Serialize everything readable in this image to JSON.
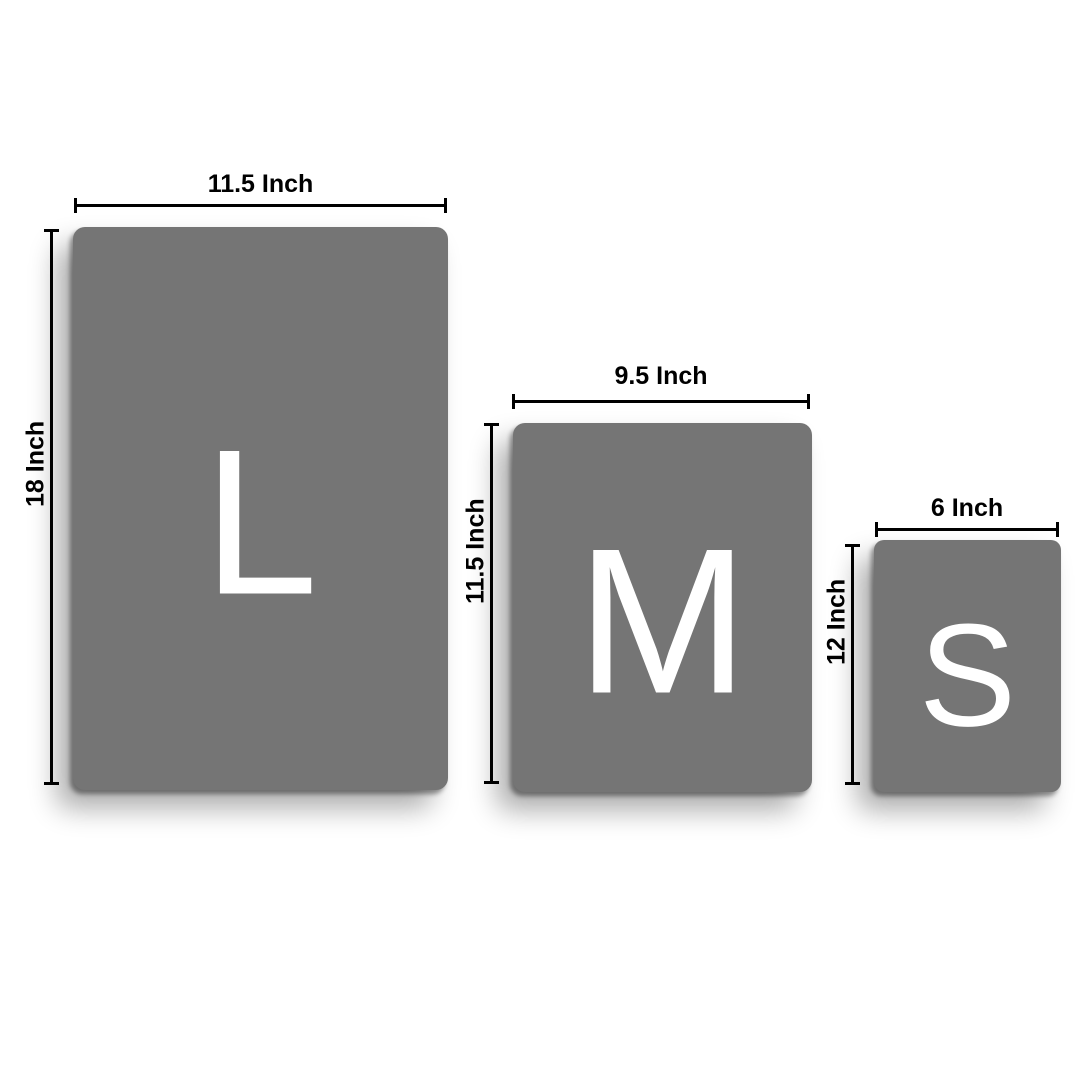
{
  "colors": {
    "background": "#ffffff",
    "panel_fill": "#757575",
    "letter_color": "#ffffff",
    "dimension_color": "#000000"
  },
  "sizes": [
    {
      "name": "large",
      "letter": "L",
      "width_label": "11.5 Inch",
      "height_label": "18 Inch"
    },
    {
      "name": "medium",
      "letter": "M",
      "width_label": "9.5 Inch",
      "height_label": "11.5 Inch"
    },
    {
      "name": "small",
      "letter": "S",
      "width_label": "6 Inch",
      "height_label": "12 Inch"
    }
  ]
}
